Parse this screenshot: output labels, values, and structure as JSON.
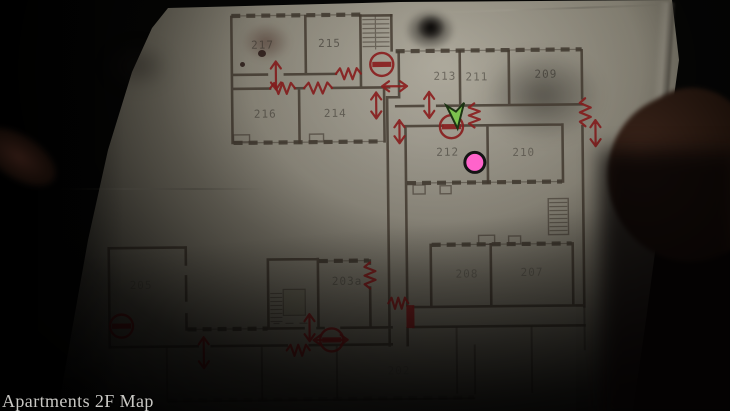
{
  "hud": {
    "map_label": "Apartments 2F Map"
  },
  "map": {
    "floor": "2F",
    "rooms": [
      {
        "number": "217",
        "x": 264,
        "y": 47,
        "o": 0.5
      },
      {
        "number": "215",
        "x": 331,
        "y": 46,
        "o": 0.55
      },
      {
        "number": "216",
        "x": 266,
        "y": 116,
        "o": 0.5
      },
      {
        "number": "214",
        "x": 336,
        "y": 116,
        "o": 0.5
      },
      {
        "number": "213",
        "x": 446,
        "y": 80,
        "o": 0.5
      },
      {
        "number": "211",
        "x": 478,
        "y": 81,
        "o": 0.5
      },
      {
        "number": "209",
        "x": 547,
        "y": 79,
        "o": 0.55
      },
      {
        "number": "212",
        "x": 448,
        "y": 156,
        "o": 0.5
      },
      {
        "number": "210",
        "x": 524,
        "y": 157,
        "o": 0.45
      },
      {
        "number": "203a",
        "x": 346,
        "y": 284,
        "o": 0.4
      },
      {
        "number": "208",
        "x": 466,
        "y": 278,
        "o": 0.32
      },
      {
        "number": "207",
        "x": 531,
        "y": 277,
        "o": 0.32
      },
      {
        "number": "205",
        "x": 140,
        "y": 286,
        "o": 0.28
      },
      {
        "number": "202",
        "x": 397,
        "y": 374,
        "o": 0.2
      }
    ],
    "markers": {
      "player": {
        "x": 457,
        "y": 116
      },
      "pink_dot": {
        "x": 475,
        "y": 163,
        "r": 10
      },
      "locked_doors": [
        {
          "x": 383,
          "y": 64
        },
        {
          "x": 452,
          "y": 127
        },
        {
          "x": 120,
          "y": 323
        },
        {
          "x": 330,
          "y": 339
        }
      ],
      "barred_doors": [
        {
          "x": 405,
          "y": 305,
          "w": 8,
          "h": 23
        }
      ],
      "zigzag_doors": [
        {
          "dir": "h",
          "x1": 271,
          "x2": 296,
          "y": 87
        },
        {
          "dir": "h",
          "x1": 305,
          "x2": 333,
          "y": 87
        },
        {
          "dir": "h",
          "x1": 337,
          "x2": 362,
          "y": 73
        },
        {
          "dir": "v",
          "x": 475,
          "y1": 104,
          "y2": 128
        },
        {
          "dir": "v",
          "x": 586,
          "y1": 100,
          "y2": 128
        },
        {
          "dir": "v",
          "x": 369,
          "y1": 262,
          "y2": 288
        },
        {
          "dir": "h",
          "x1": 387,
          "x2": 407,
          "y": 303
        },
        {
          "dir": "h",
          "x1": 285,
          "x2": 308,
          "y": 349
        }
      ],
      "door_arrows": [
        {
          "dir": "v",
          "x": 277,
          "y1": 60,
          "y2": 88
        },
        {
          "dir": "h",
          "x1": 383,
          "x2": 408,
          "y": 86
        },
        {
          "dir": "v",
          "x": 430,
          "y1": 92,
          "y2": 118
        },
        {
          "dir": "v",
          "x": 377,
          "y1": 92,
          "y2": 118
        },
        {
          "dir": "v",
          "x": 400,
          "y1": 120,
          "y2": 143
        },
        {
          "dir": "v",
          "x": 596,
          "y1": 122,
          "y2": 148
        },
        {
          "dir": "v",
          "x": 308,
          "y1": 313,
          "y2": 340
        },
        {
          "dir": "h",
          "x1": 312,
          "x2": 346,
          "y": 339
        },
        {
          "dir": "v",
          "x": 202,
          "y1": 335,
          "y2": 366
        }
      ]
    },
    "colors": {
      "annotation_red": "#8e2020",
      "player_green": "#7cc24e",
      "player_outline": "#1c3313",
      "pink": "#ff63cb",
      "pink_outline": "#141414",
      "wall": "#463d33",
      "label": "#2e2a24",
      "hud_text": "#c9c8c4"
    }
  }
}
